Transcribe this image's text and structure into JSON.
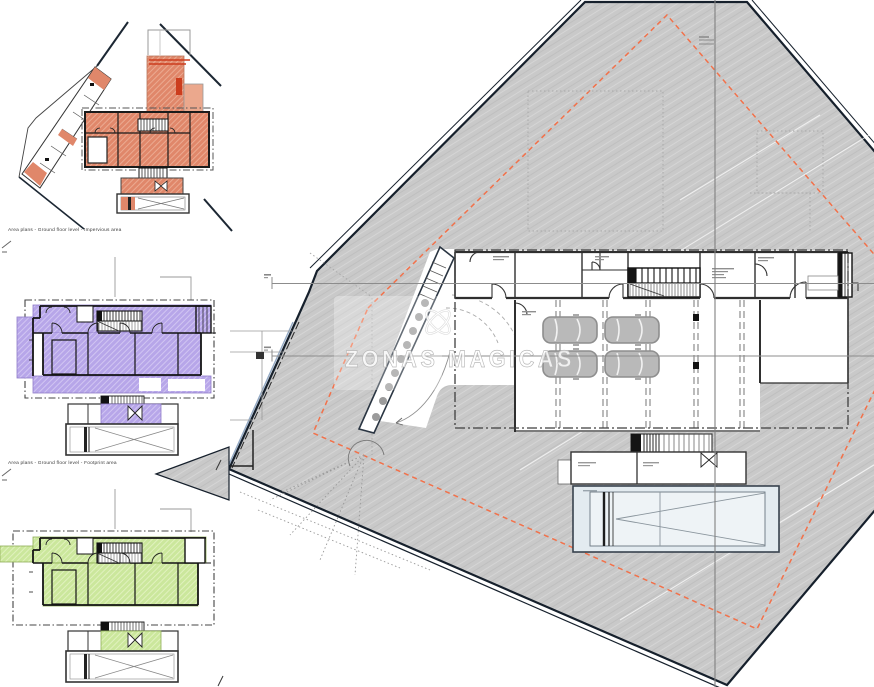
{
  "sheet": {
    "type": "architectural-area-plan-sheet",
    "captions": {
      "diagram1": "Area plans - Ground floor level - Impervious area",
      "diagram2": "Area plans - Ground floor level - Footprint area"
    },
    "watermark": {
      "text": "ZONAS MAGICAS",
      "glyph": "celtic-knot"
    },
    "colors": {
      "site_fill": "#c9c9c9",
      "site_boundary": "#16202c",
      "setback_dashed": "#f2714a",
      "impervious_area": "#e0876a",
      "impervious_roof_lines": "#cc3d1e",
      "footprint_area": "#b7a6e9",
      "green_area": "#cbe79c",
      "pool_fill": "#e3ebf0",
      "envelope_dashdot": "#3f3f3f"
    }
  }
}
